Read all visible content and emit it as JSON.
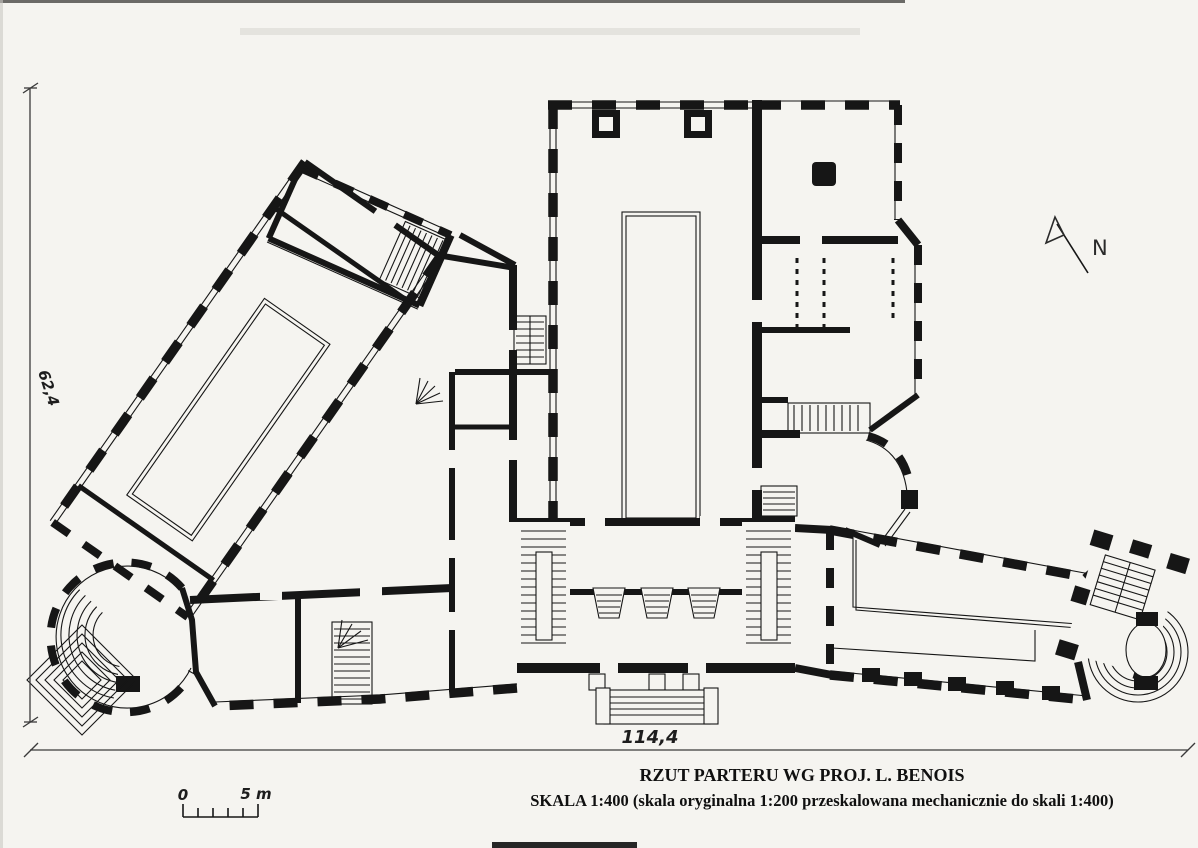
{
  "page": {
    "title_line1": "RZUT PARTERU WG PROJ. L. BENOIS",
    "title_line2": "SKALA 1:400 (skala oryginalna 1:200 przeskalowana mechanicznie do skali 1:400)"
  },
  "annotations": {
    "north_label": "N",
    "dim_left": "62,4",
    "dim_bottom": "114,4",
    "scalebar_zero": "0",
    "scalebar_five": "5 m"
  },
  "colors": {
    "paper": "#f5f4f0",
    "ink": "#161616",
    "dim_line": "#3a3a3a"
  }
}
